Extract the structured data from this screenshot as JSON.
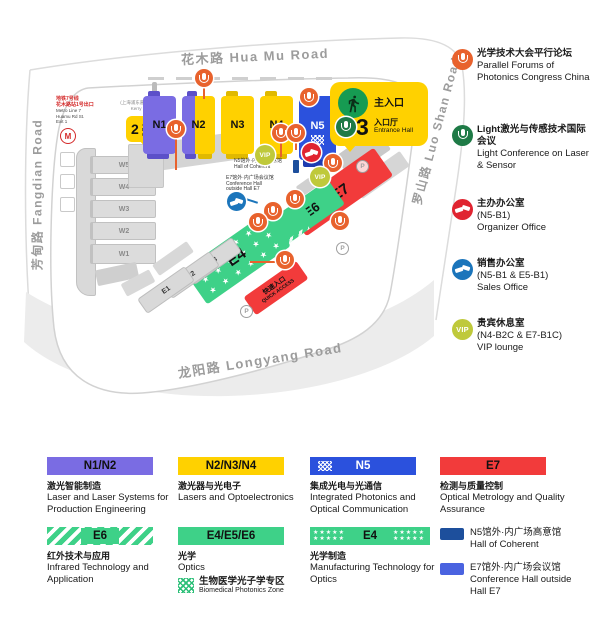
{
  "map": {
    "roads": {
      "top": "花木路  Hua Mu Road",
      "left": "芳甸路  Fangdian Road",
      "right": "罗山路  Luo Shan Road",
      "bottom": "龙阳路  Longyang Road"
    },
    "halls": {
      "n1": "N1",
      "n2": "N2",
      "n3": "N3",
      "n4": "N4",
      "n5": "N5",
      "w1": "W1",
      "w2": "W2",
      "w3": "W3",
      "w4": "W4",
      "w5": "W5",
      "e1": "E1",
      "e2": "E2",
      "e3": "E3",
      "e4": "E4",
      "e5": "E5",
      "e6": "E6",
      "e7": "E7"
    },
    "entrance2": {
      "number": "2",
      "label_zh": "入口厅",
      "label_en": "Entrance Hall"
    },
    "entrance3": {
      "main_label": "主入口",
      "number": "3",
      "label_zh": "入口厅",
      "label_en": "Entrance Hall"
    },
    "quick_access": {
      "zh": "快速入口",
      "en": "QUICK ACCESS"
    },
    "metro": {
      "zh1": "地铁7号线",
      "zh2": "花木路站1号出口",
      "en1": "Metro Line 7",
      "en2": "Huamu Rd St.",
      "en3": "Exit 1",
      "logo": "M"
    },
    "hotel": {
      "zh": "(上海浦东嘉里大酒店)",
      "en": "Kerry Hotel"
    },
    "notes": {
      "coherent_zh": "N5馆外·内广场高意馆",
      "coherent_en": "Hall of Coherent",
      "conference_zh": "E7馆外·内广场会议馆",
      "conference_en": "Conference Hall outside Hall E7"
    },
    "vip_label": "VIP",
    "parking_label": "P",
    "stars_row": "★ ★ ★ ★ ★ ★"
  },
  "side_legend": {
    "vip_label": "VIP",
    "items": [
      {
        "zh": "光学技术大会平行论坛",
        "en": "Parallel Forums of Photonics Congress China"
      },
      {
        "zh": "Light激光与传感技术国际会议",
        "en": "Light Conference on Laser & Sensor"
      },
      {
        "zh": "主办办公室",
        "loc": "(N5-B1)",
        "en": "Organizer Office"
      },
      {
        "zh": "销售办公室",
        "loc": "(N5-B1 & E5-B1)",
        "en": "Sales Office"
      },
      {
        "zh": "贵宾休息室",
        "loc": "(N4-B2C & E7-B1C)",
        "en": "VIP lounge"
      }
    ]
  },
  "bottom_legend": {
    "stars": "★★★★★",
    "items": [
      {
        "halls": "N1/N2",
        "zh": "激光智能制造",
        "en": "Laser and Laser Systems for Production Engineering"
      },
      {
        "halls": "N2/N3/N4",
        "zh": "激光器与光电子",
        "en": "Lasers and Optoelectronics"
      },
      {
        "halls": "N5",
        "zh": "集成光电与光通信",
        "en": "Integrated Photonics and Optical Communication"
      },
      {
        "halls": "E7",
        "zh": "检测与质量控制",
        "en": "Optical Metrology and Quality Assurance"
      },
      {
        "halls": "E6",
        "zh": "红外技术与应用",
        "en": "Infrared Technology and Application"
      },
      {
        "halls": "E4/E5/E6",
        "zh": "光学",
        "en": "Optics"
      },
      {
        "halls": "E4",
        "zh": "光学制造",
        "en": "Manufacturing Technology for Optics"
      }
    ],
    "biomedical": {
      "zh": "生物医学光子学专区",
      "en": "Biomedical Photonics Zone"
    },
    "outside": [
      {
        "zh": "N5馆外·内广场高意馆",
        "en": "Hall of Coherent"
      },
      {
        "zh": "E7馆外·内广场会议馆",
        "en": "Conference Hall outside Hall E7"
      }
    ]
  },
  "colors": {
    "purple": "#7a6ce3",
    "yellow": "#ffd100",
    "blue": "#2b51dd",
    "red": "#f23b3b",
    "green": "#3ed188",
    "orange": "#e8622d",
    "dark_green": "#1e7a46",
    "olive": "#bfc93b",
    "navy": "#1d4f9c",
    "royal": "#4a63e0"
  }
}
